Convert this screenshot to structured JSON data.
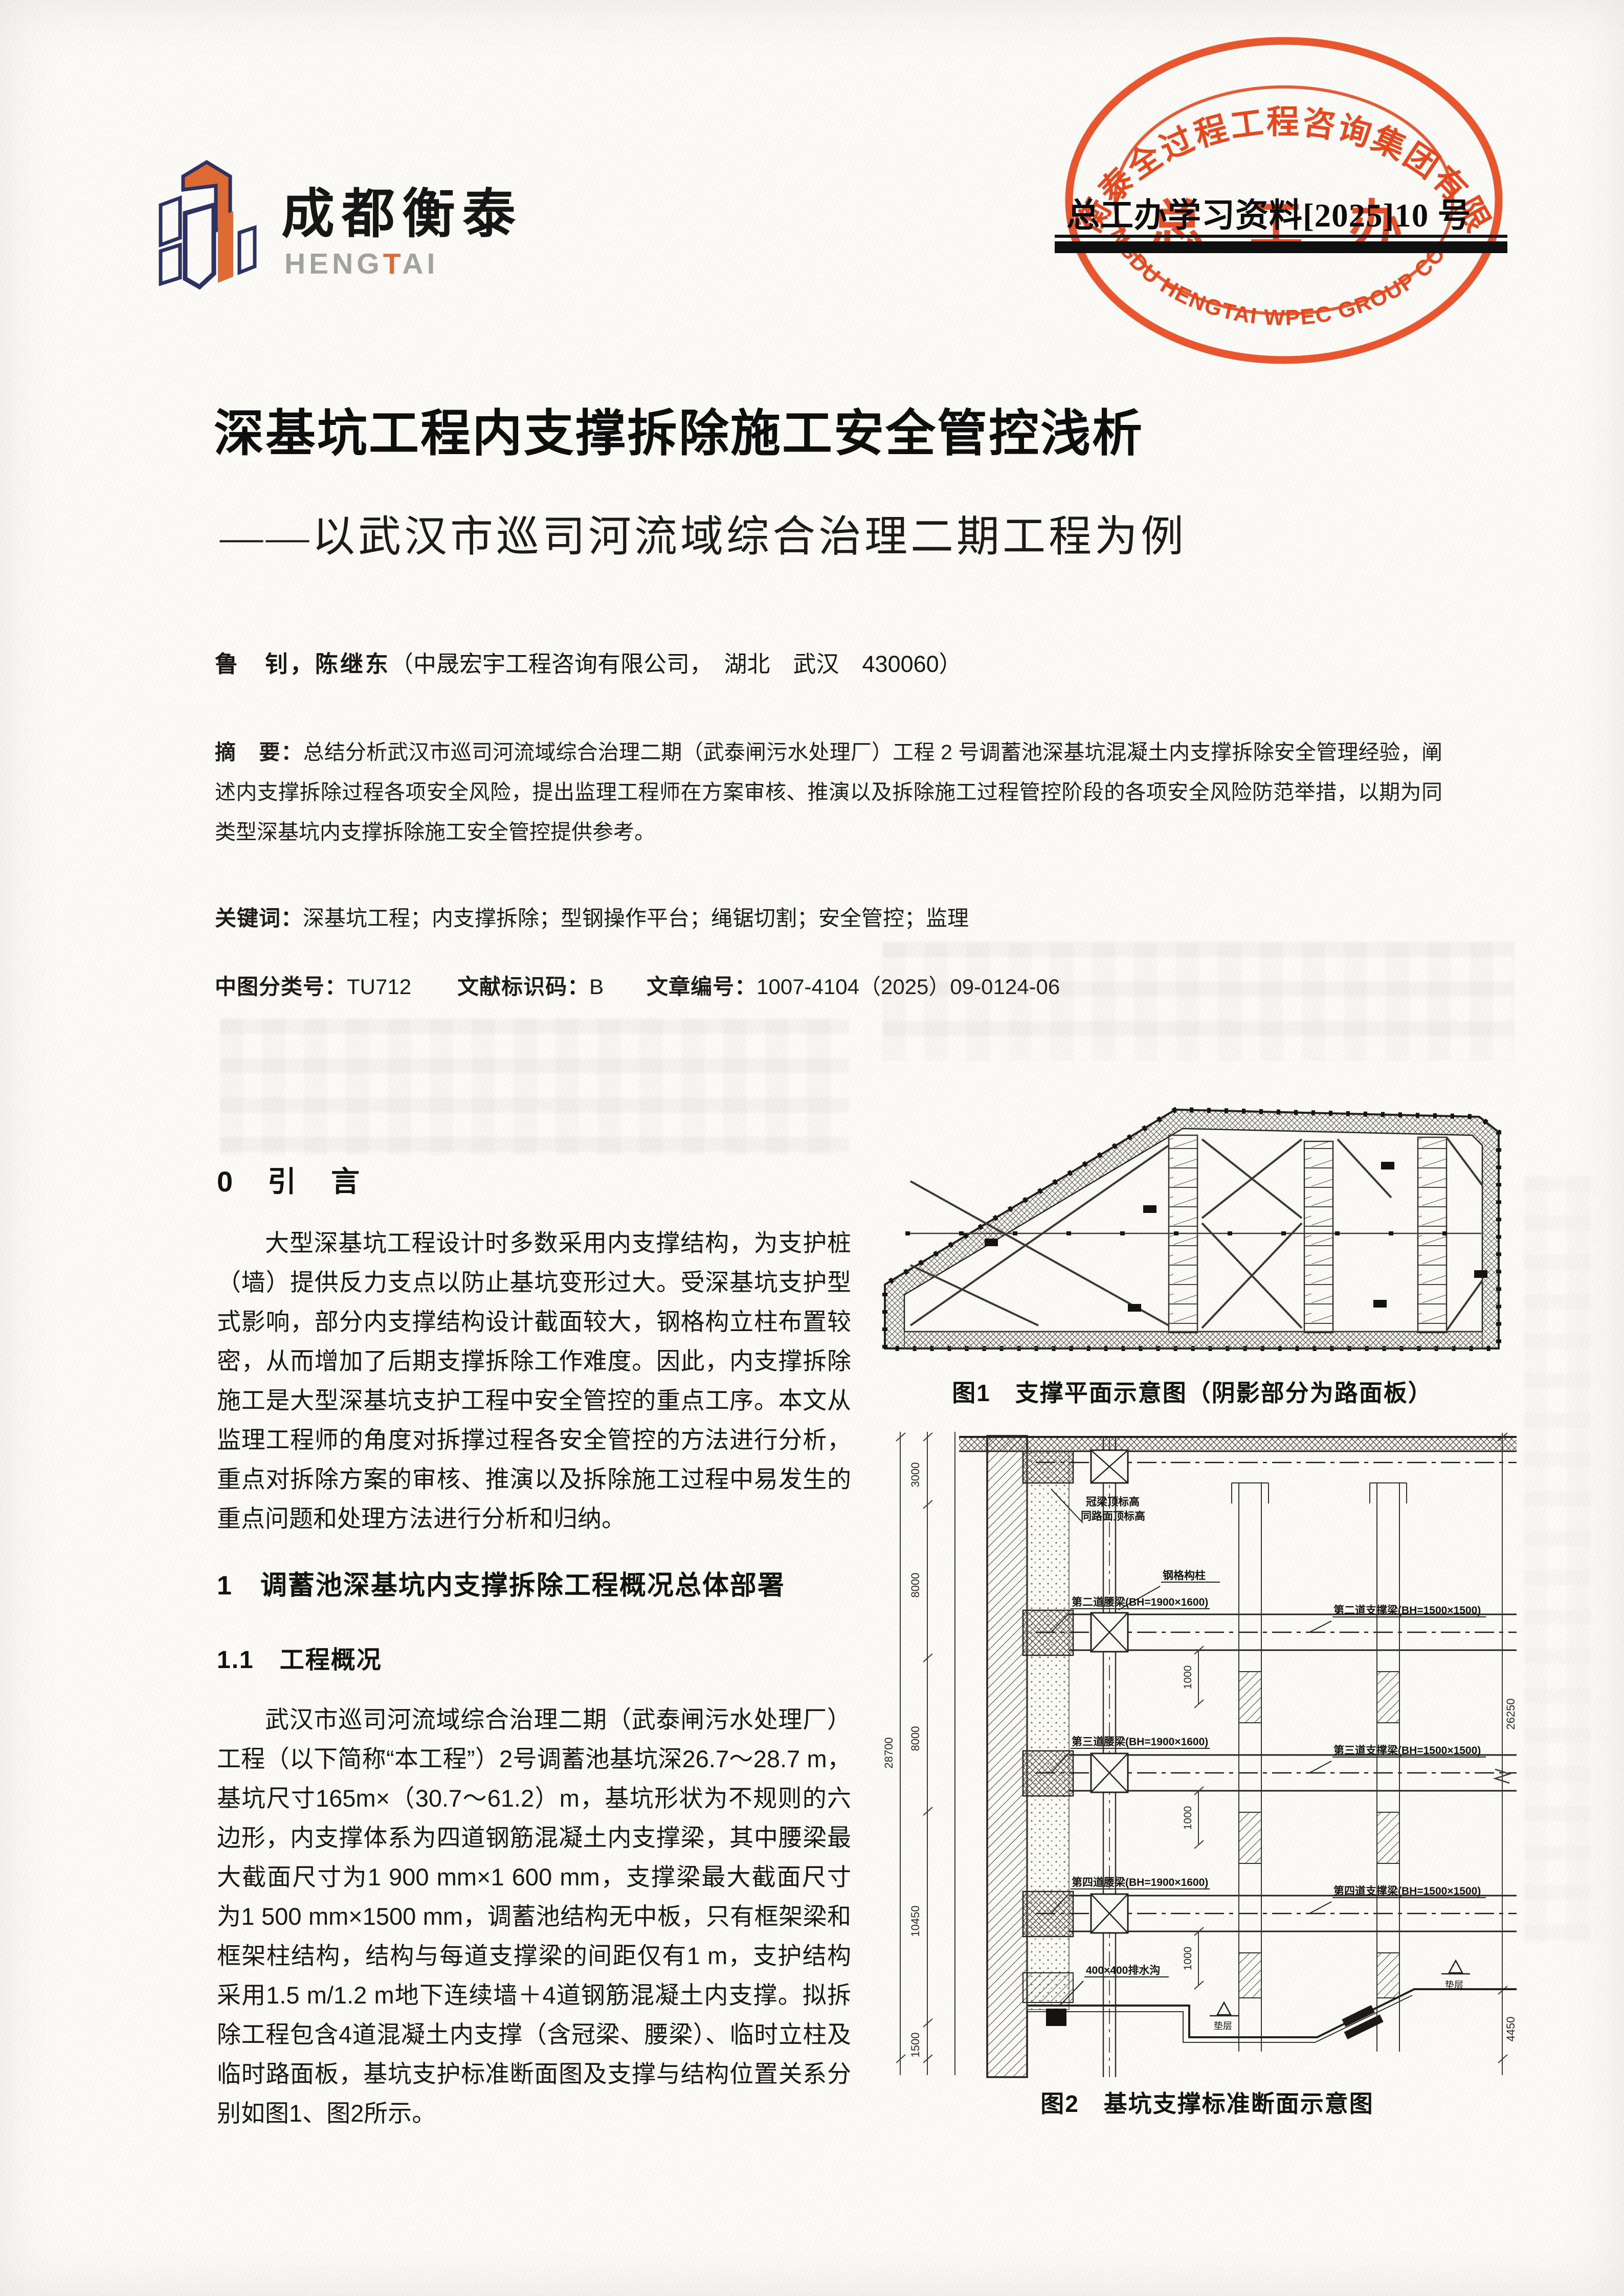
{
  "logo": {
    "cn": "成都衡泰",
    "en_pre": "HENG",
    "en_t": "T",
    "en_post": "AI",
    "orange": "#df6b33",
    "navy": "#2c3262"
  },
  "stamp": {
    "arc_top": "成都衡泰全过程工程咨询集团有限公司",
    "arc_bottom": "CHENGDU HENGTAI WPEC GROUP CO., LTD.",
    "center": "总 工 办",
    "overlay": "总工办学习资料[2025]10 号",
    "color": "#e8481c"
  },
  "article": {
    "title": "深基坑工程内支撑拆除施工安全管控浅析",
    "subtitle": "——以武汉市巡司河流域综合治理二期工程为例",
    "authors": "鲁　钊，陈继东",
    "affiliation": "（中晟宏宇工程咨询有限公司，　湖北　武汉　430060）",
    "abstract_label": "摘　要：",
    "abstract_text": "总结分析武汉市巡司河流域综合治理二期（武泰闸污水处理厂）工程 2 号调蓄池深基坑混凝土内支撑拆除安全管理经验，阐述内支撑拆除过程各项安全风险，提出监理工程师在方案审核、推演以及拆除施工过程管控阶段的各项安全风险防范举措，以期为同类型深基坑内支撑拆除施工安全管控提供参考。",
    "keywords_label": "关键词：",
    "keywords_text": "深基坑工程；内支撑拆除；型钢操作平台；绳锯切割；安全管控；监理",
    "clc_label": "中图分类号：",
    "clc": "TU712",
    "code_label": "文献标识码：",
    "code": "B",
    "id_label": "文章编号：",
    "id": "1007-4104（2025）09-0124-06"
  },
  "sections": {
    "s0_heading": "0　引　言",
    "s0_para": "大型深基坑工程设计时多数采用内支撑结构，为支护桩（墙）提供反力支点以防止基坑变形过大。受深基坑支护型式影响，部分内支撑结构设计截面较大，钢格构立柱布置较密，从而增加了后期支撑拆除工作难度。因此，内支撑拆除施工是大型深基坑支护工程中安全管控的重点工序。本文从监理工程师的角度对拆撑过程各安全管控的方法进行分析，重点对拆除方案的审核、推演以及拆除施工过程中易发生的重点问题和处理方法进行分析和归纳。",
    "s1_heading": "1　调蓄池深基坑内支撑拆除工程概况总体部署",
    "s11_heading": "1.1　工程概况",
    "s11_para": "武汉市巡司河流域综合治理二期（武泰闸污水处理厂）工程（以下简称“本工程”）2号调蓄池基坑深26.7～28.7 m，基坑尺寸165m×（30.7～61.2）m，基坑形状为不规则的六边形，内支撑体系为四道钢筋混凝土内支撑梁，其中腰梁最大截面尺寸为1 900 mm×1 600 mm，支撑梁最大截面尺寸为1 500 mm×1500 mm，调蓄池结构无中板，只有框架梁和框架柱结构，结构与每道支撑梁的间距仅有1 m，支护结构采用1.5 m/1.2 m地下连续墙＋4道钢筋混凝土内支撑。拟拆除工程包含4道混凝土内支撑（含冠梁、腰梁）、临时立柱及临时路面板，基坑支护标准断面图及支撑与结构位置关系分别如图1、图2所示。"
  },
  "figures": {
    "fig1": {
      "caption": "图1　支撑平面示意图（阴影部分为路面板）"
    },
    "fig2": {
      "caption": "图2　基坑支撑标准断面示意图",
      "label_crown_1": "冠梁顶标高",
      "label_crown_2": "同路面顶标高",
      "label_column": "钢格构柱",
      "label_waler2": "第二道腰梁(BH=1900×1600)",
      "label_strut2": "第二道支撑梁(BH=1500×1500)",
      "label_waler3": "第三道腰梁(BH=1900×1600)",
      "label_strut3": "第三道支撑梁(BH=1500×1500)",
      "label_waler4": "第四道腰梁(BH=1900×1600)",
      "label_strut4": "第四道支撑梁(BH=1500×1500)",
      "label_drain": "400×400排水沟",
      "label_cushion": "垫层",
      "dim_total_left": "28700",
      "dims_left": [
        "3000",
        "8000",
        "8000",
        "10450",
        "1500"
      ],
      "dim_right_total": "26250",
      "dim_right_bottom": "4450",
      "dim_spacing": "1000"
    }
  }
}
